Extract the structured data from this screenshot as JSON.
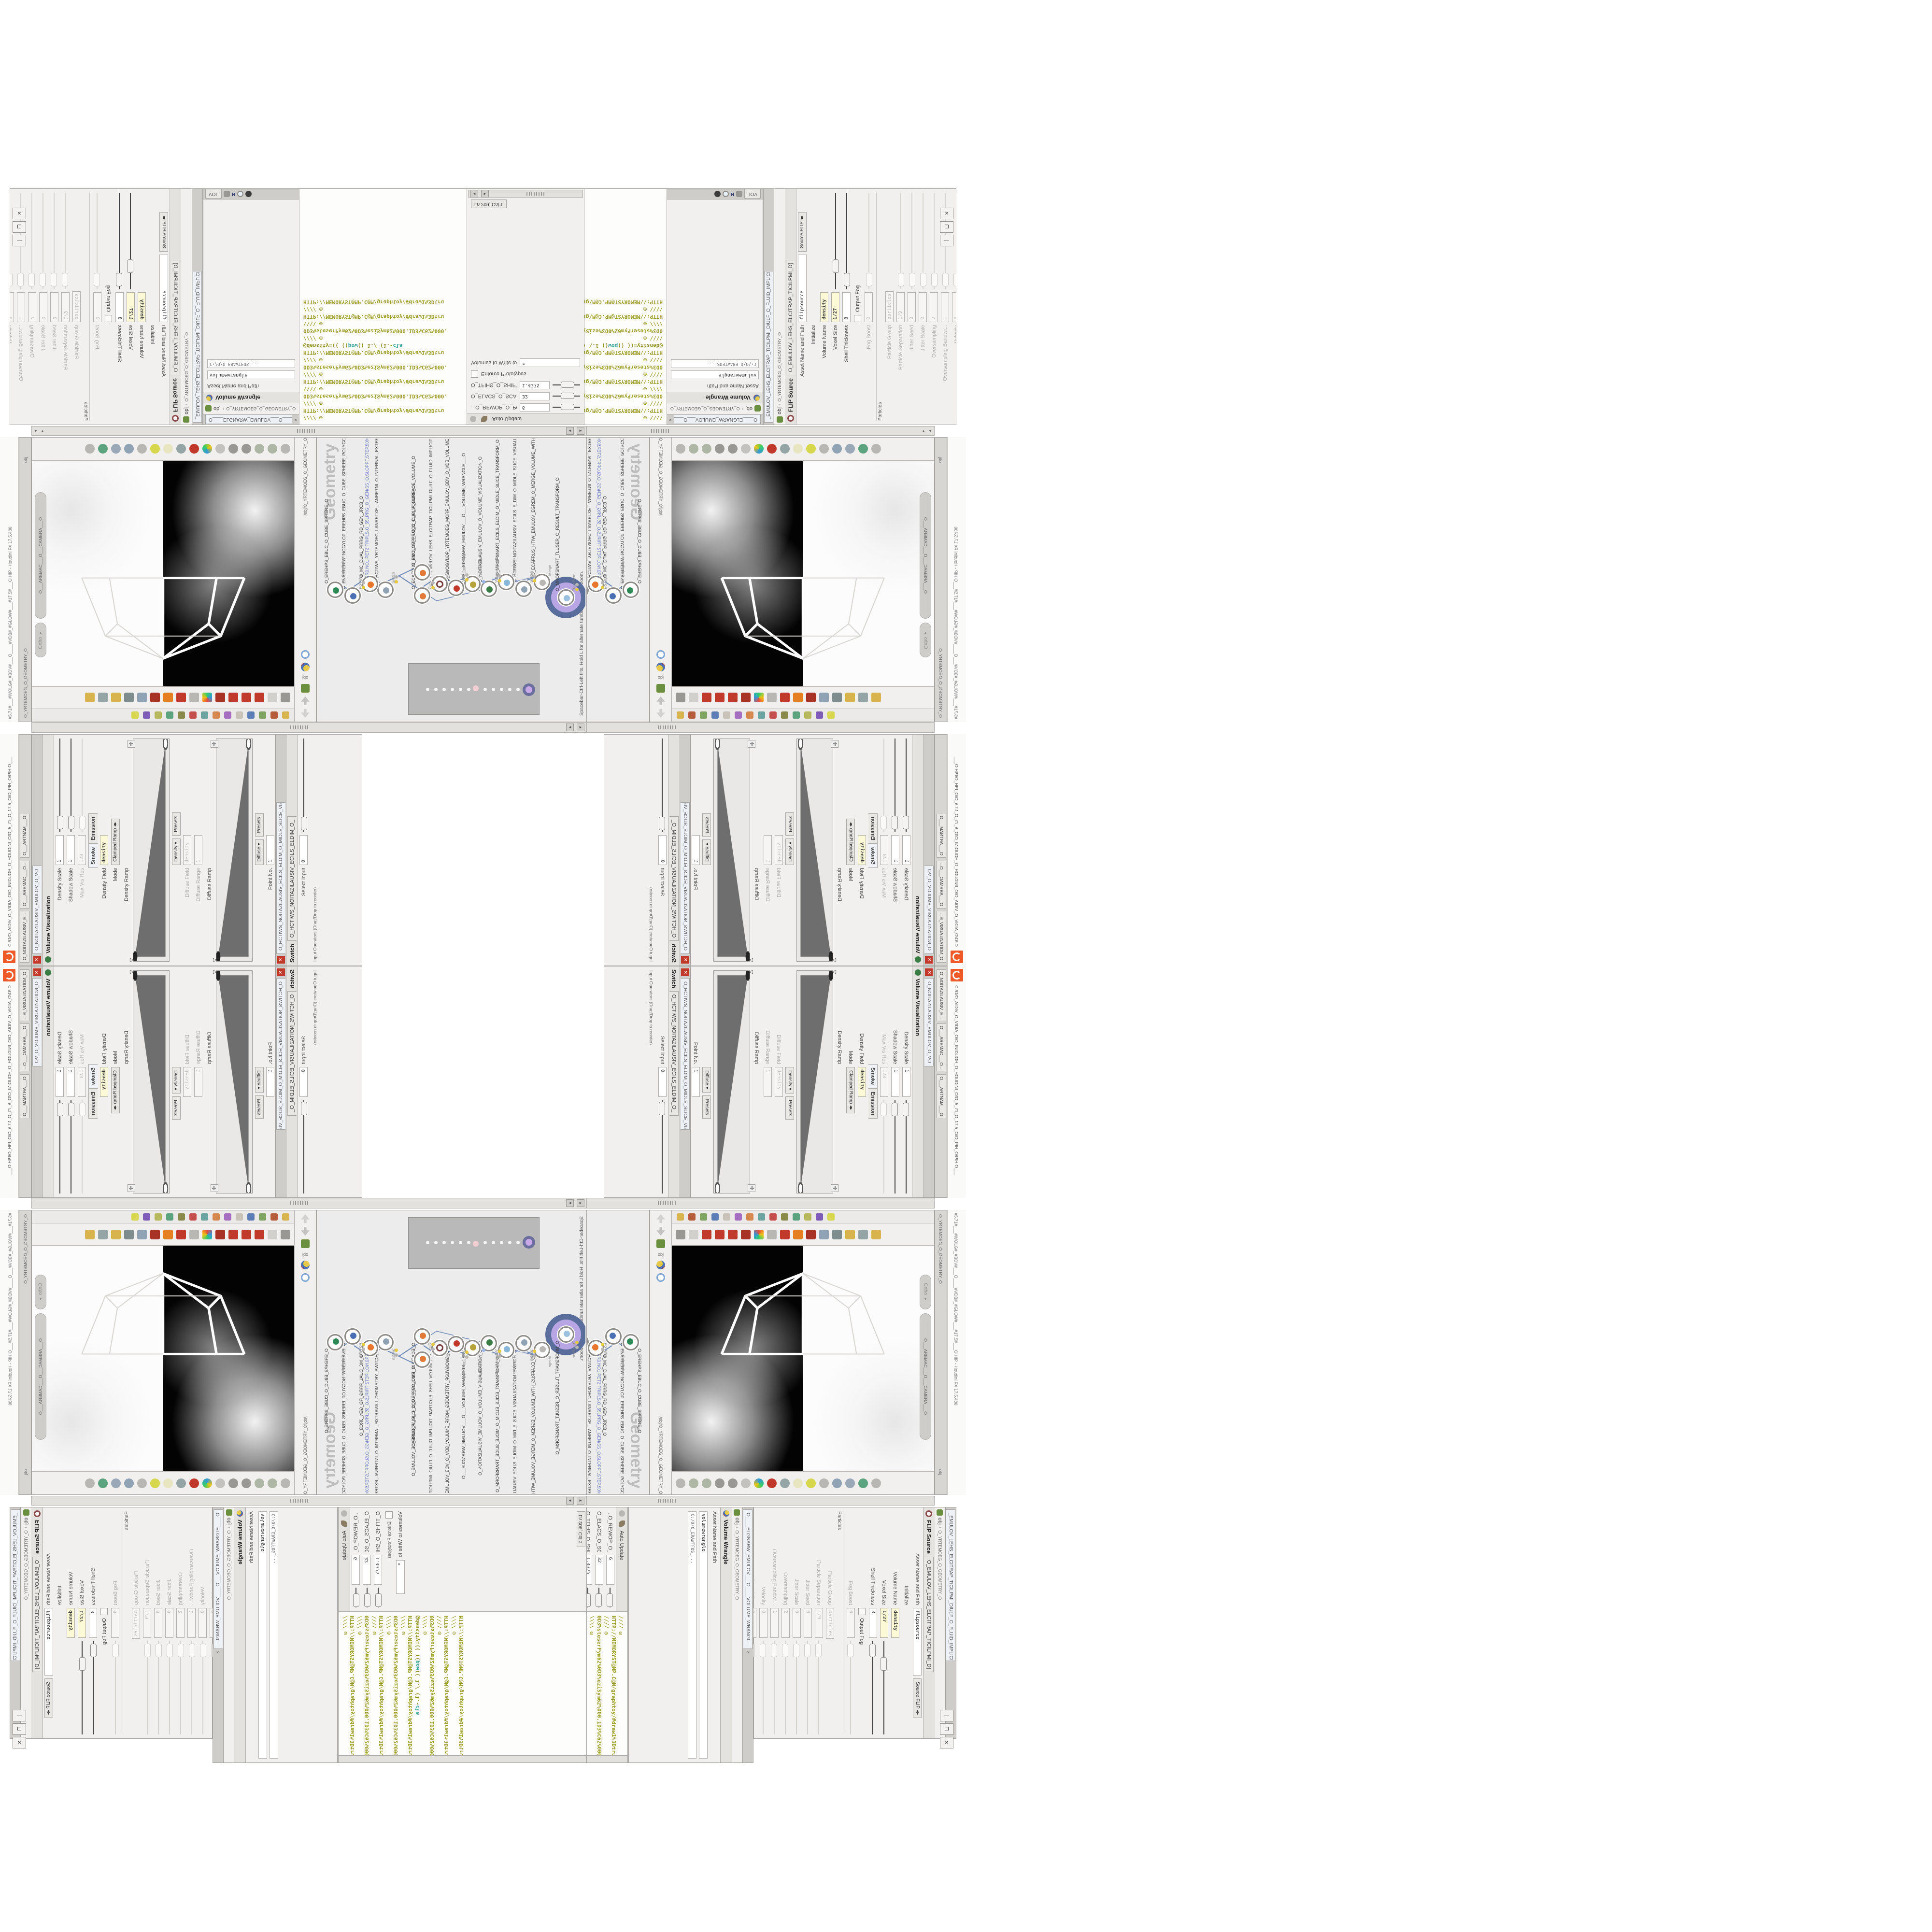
{
  "colors": {
    "accent_orange": "#f05a28",
    "code_olive": "#9b9b25",
    "code_teal": "#2d9d96",
    "select_purple": "#b7a6e3",
    "wire_blue": "#6b87b7",
    "flag_yellow": "#e6c93f",
    "net_gray": "#c9c9c9"
  },
  "window": {
    "title_path": "C:/O/O_AIDIV_O_VIDIA_O/O_INIDUOH_O_HOUDINI_O/O_5_71_O_17.5_O/O_PIH_O/PIH.O___",
    "hash_strip": "#5.71#___#WOLG#_#BDV#___O____#VDB#_#GLOW#___#17.5#___O.HIP - Houdini FX 17.5.480",
    "buttons": {
      "min": "—",
      "max": "❐",
      "close": "✕"
    }
  },
  "center_tabs": [
    "O_NOITAZILAUSIV_E...",
    "O___AREMAC___O...",
    "O___ARTNAM___O"
  ],
  "breadcrumb": {
    "root": "obj",
    "node": "O_YRTEMOEG_O_GEOMETRY_O",
    "vp_path": "/obj/O_YRTEMOEG_O_GEOMETRY_O"
  },
  "paths": {
    "softwarepath": "C:/O/O_ERAWTFOS_...",
    "voltab": "VOL"
  },
  "flip": {
    "title": "FLIP Source",
    "tab": "O_EMULOV_LEHS_ELCITRAP_TICILPMI_D]",
    "tab_long": "_EMULOV_LEHS_ELCITRAP_TICILPMI_DIULF_O_FLUID_IMPLICIT_PARTICLE...",
    "asset_label": "Asset Name and Path",
    "asset_value": "flipsource",
    "source_btn": "Source FLIP",
    "rows": [
      {
        "label": "Initialize",
        "kind": "blank"
      },
      {
        "label": "Volume Name",
        "value": "density",
        "yellow": true
      },
      {
        "label": "Voxel Size",
        "value": "1/27",
        "yellow": true,
        "slider": true
      },
      {
        "label": "Shell Thickness",
        "value": "3",
        "slider": true
      },
      {
        "label": "",
        "check": "Output Fog"
      },
      {
        "label": "Fog Boost",
        "value": "0",
        "gray": true,
        "slider": "faint"
      },
      {
        "section": "Particles"
      },
      {
        "label": "Particle Group",
        "value": "particles",
        "gray": true
      },
      {
        "label": "Particle Separation",
        "value": "1/9",
        "gray": true,
        "slider": "faint"
      },
      {
        "label": "Jitter Seed",
        "value": "0",
        "gray": true,
        "slider": "faint"
      },
      {
        "label": "Jitter Scale",
        "value": "0",
        "gray": true,
        "slider": "faint"
      },
      {
        "label": "Oversampling",
        "value": "2",
        "gray": true,
        "slider": "faint"
      },
      {
        "label": "Oversampling Bandwi...",
        "value": "1",
        "gray": true,
        "slider": "faint"
      },
      {
        "label": "Velocity",
        "value": "0",
        "gray": true,
        "slider": "faint"
      },
      {
        "label": "Rest Offset",
        "value": "0",
        "gray": true,
        "slider": "faint"
      },
      {
        "label": "",
        "check": "Add Rest Attribute",
        "flagicon": true
      },
      {
        "label": "",
        "check": "Dual Rest Attributes"
      },
      {
        "label": "",
        "check": "Create Particles",
        "bold": true
      }
    ]
  },
  "wrangle": {
    "title": "Volume Wrangle",
    "name_value": "volumewrangle",
    "asset_label": "Asset Name and Path",
    "tab": "O____ELGNARW_EMULOV___O____VOLUME_WRANGL...",
    "close": "×",
    "autoupdate": "Auto Update",
    "lncol": "Ln 209, Col 1",
    "volumes_label": "Volumes to Write to",
    "volumes_value": "*",
    "enforce": "Enforce Prototypes",
    "sliders": [
      {
        "label": "...O_REWOP_O_POWER_O",
        "value": "6"
      },
      {
        "label": "O_ELACS_O_SCALE_O",
        "value": "32"
      },
      {
        "label": "O_TFIHS_O_SHIFT_O",
        "value": "1.4375"
      }
    ]
  },
  "code": {
    "lines": [
      {
        "k": "cl-com",
        "t": "//// ◎ HTTP://MEMORYST@MP.C@M/graphtoy/#draw1%3Dtru"
      },
      {
        "k": "cl-com",
        "t": "//// ◎ 0D3%steserPym62%0D3%eziSym62%000.1D3%C62%000."
      },
      {
        "k": "cl-com",
        "t": "\\\\\\\\ ◎ HTTP://MEMORYST@MP.C@M/graphtoy/#draw1%3Dtru"
      },
      {
        "k": "cl-com",
        "t": "//// ◎ 0D3%steserPym62%0D3%eziSym62%000.1D3%C62%000."
      },
      {
        "k": "cl-com",
        "t": "//// ◎ HTTP://MEMORYST@MP.C@M/graphtoy/#draw1%3Dtru"
      },
      {
        "k": "mix",
        "parts": [
          {
            "k": "cl-code",
            "t": "@density=((  (("
          },
          {
            "k": "cl-kw",
            "t": "pow"
          },
          {
            "k": "cl-code",
            "t": "((  1./ (1.-"
          },
          {
            "k": "cl-kw",
            "t": "cla"
          }
        ]
      },
      {
        "k": "cl-com",
        "t": "//// ◎ 0D3%steserPym62%0D3%eziSym62%000.1D3%C62%000."
      },
      {
        "k": "cl-com",
        "t": "\\\\\\\\ ◎ HTTP://MEMORYST@MP.C@M/graphtoy/#draw1%3Dtru"
      },
      {
        "k": "cl-com",
        "t": "//// ◎ HTTP://MEMORYST@MP.C@M/graphtoy/#draw1%3Dtru"
      }
    ]
  },
  "viz": {
    "title": "Volume Visualization",
    "tab": "O_NOITAZILAUSIV_EMULOV_O_VO",
    "tabs": [
      "Smoke",
      "Emission"
    ],
    "rows1": [
      {
        "label": "Density Scale",
        "value": "1",
        "slider": true
      },
      {
        "label": "Shadow Scale",
        "value": "1",
        "slider": true
      },
      {
        "label": "Max Vis Res",
        "value": "128",
        "gray": true,
        "slider": "faint"
      }
    ],
    "density_field_label": "Density Field",
    "density_field": "density",
    "mode_label": "Mode",
    "mode": "Clamped Ramp",
    "density_ramp_label": "Density Ramp",
    "presets": "Presets",
    "presets_kind": "Density",
    "diffuse_field_label": "Diffuse Field",
    "diffuse_range_label": "Diffuse Range",
    "diffuse_range": "1",
    "diffuse_ramp_label": "Diffuse Ramp",
    "presets_kind2": "Diffuse",
    "point_rows": [
      {
        "label": "Point No.",
        "value": "1"
      },
      {
        "label": "Position",
        "value": "1.8125"
      },
      {
        "label": "Color",
        "value": "",
        "color": true
      },
      {
        "label": "Interpolation",
        "value": "Linear",
        "dropdown": true
      },
      {
        "label": "",
        "value": "1.8125"
      },
      {
        "label": "",
        "value": "1.8125"
      }
    ]
  },
  "switch": {
    "title": "Switch",
    "tab": "O_HCTIWS_NOITAZILAUSIV_ECILS_ELDIM_O_",
    "tab_long": "O_HCTIWS_NOITAZILAUSIV_ECILS_ELDIM_O_MIDLE_SLICE_VISUALIZATION...",
    "select_label": "Select Input",
    "select_value": "0",
    "note": "Input Operators (Drag/Drop to reorder)"
  },
  "network": {
    "hint": "Spacebar-Ctrl-Left tilts. Hold L for alternate tumble, dolly, and zoom.",
    "watermark": "Geometry",
    "nodes": [
      {
        "type": "Transform",
        "name": "O_MROFSNART_TLUSER_O_RESULT_TRANSFORM_O",
        "glyph": "#9ac0dd",
        "selected": true
      },
      {
        "type": "Merge",
        "name": "O_ECAFRUS_HTIW_EMULOV_EGREM_O_MERGE_VOLUME_WITH_SURFACE_O",
        "glyph": "#b9b7b3"
      },
      {
        "type": "Switch",
        "name": "O_HCTIWS_NOITAZILAUSIV_ECILS_ELDIM_O_MIDLE_SLICE_VISUALIZATION_SWITCH_O",
        "glyph": "#8fa3b5"
      },
      {
        "type": "Transform",
        "name": "O_MROFSNART_ECILS_ELDIM_O_MIDLE_SLICE_TRANSFORM_O",
        "glyph": "#88b7d8"
      },
      {
        "type": "VolumeVisualiza",
        "name": "O_NOITAZILAUSIV_EMULOV_O_VOLUME_VISUALIZATION_O",
        "glyph": "#3a7d44"
      },
      {
        "type": "Volume Wrangle",
        "name": "O___ELGNARW_EMULOV___O___VOLUME_WRANGLE___O",
        "glyph": "#b6a23a",
        "display": true
      },
      {
        "type": "VDB from Polygons",
        "name": "O_SNOGYLOP_YRTEMOEG_MORF_EMULOV_BDV_O_VDB_VOLUME_FROM_GEOMETRY_POLYG",
        "glyph": "#c0392b"
      },
      {
        "type": "FLIP Source",
        "name": "O_EMULOV_LEHS_ELCITRAP_TICILPMI_DIULF_O_FLUID_IMPLICIT_PARTICLE_SHEL_VOLUME",
        "glyph": "ring"
      },
      {
        "type": "Clip",
        "name": "O_ECAFRUS_PILC_GRP_PMOC_O_CLIP_SURFACE_VOLUME_O",
        "glyph": "#e07b39"
      },
      {
        "type": "Clip",
        "name": "O_EMULOV_PILC_O_CLIP_VOLUME_O",
        "glyph": "#e07b39"
      },
      {
        "type": "Switch",
        "name": "O_HCTIWS_YRTEMOEG_LANRETXE_LANRETNI_O_INTERNAL_EXTERNAL_GEOMETRY_SWITCH_O",
        "glyph": "#8fa3b5"
      },
      {
        "type": "File",
        "name": "O_MC_DUAL_PRRG_RD_GEN_JRCB_O",
        "glyph": "#e8762c",
        "link": "JR0.NO1.PET2.TRIPLS.O_55LPRG_O_GEN/SS_O.SLOPPT.STEP.50%JOBJ"
      },
      {
        "type": "PolyWire",
        "name": "O_ENARFERIW_NOGYLOP_EREHPS_EBUC_O_CUBE_SPHERE_POLYGON_WIREFRAME_O",
        "glyph": "#4a6fb3"
      },
      {
        "type": "an_CubeSphere",
        "name": "O_EREHPS_EBUC_O_CUBE_SPHERE_O",
        "glyph": "#2e8b57"
      }
    ]
  },
  "viewport": {
    "pills": [
      "Ortho ▾",
      "O___AREMAC___O___CAMERA___O"
    ],
    "top_icons": [
      "film-loop-icon",
      "view-box-icon",
      "magnet-red-icon",
      "magnet-red-icon",
      "magnet-red-icon",
      "magnet-frame-icon",
      "star-colors-icon",
      "scissors-icon",
      "plane-red-icon",
      "swirl-orange-icon",
      "gear-red-icon",
      "toggle-2d-icon",
      "cursor-arrow-icon",
      "bucket-yellow-icon",
      "diamond-checker-icon",
      "lamp-yellow-icon"
    ],
    "bottom_icons": [
      "arrow-left-icon",
      "prism-icon",
      "prism-icon",
      "key-icon",
      "key-icon",
      "ring-icon",
      "cam-colorful-icon",
      "cam-red-icon",
      "cam-box-icon",
      "target-icon",
      "capsule-yellow-icon",
      "lens-icon",
      "eye-icon",
      "render-box-icon",
      "build-green-icon",
      "diamond-gray-icon"
    ],
    "left_icons": [
      "home-up-icon",
      "arrow-down-icon",
      "slate-icon",
      "sop-ball-icon",
      "star-icon",
      "blue-rings-icon"
    ],
    "shelf_icon_colors": [
      "#d7b44e",
      "#b85c3c",
      "#7fa360",
      "#5c7fb8",
      "#c8c2b8",
      "#a56ec0",
      "#d7884e",
      "#6aa3a0",
      "#c84e4e",
      "#8a8a4a",
      "#5ca37f",
      "#b8b85c",
      "#7f5cb8",
      "#d7d74e"
    ]
  },
  "ui_strings": {
    "ortho": "Ortho",
    "obj": "obj",
    "asse": "Asse",
    "particles_ghost": "particles"
  }
}
